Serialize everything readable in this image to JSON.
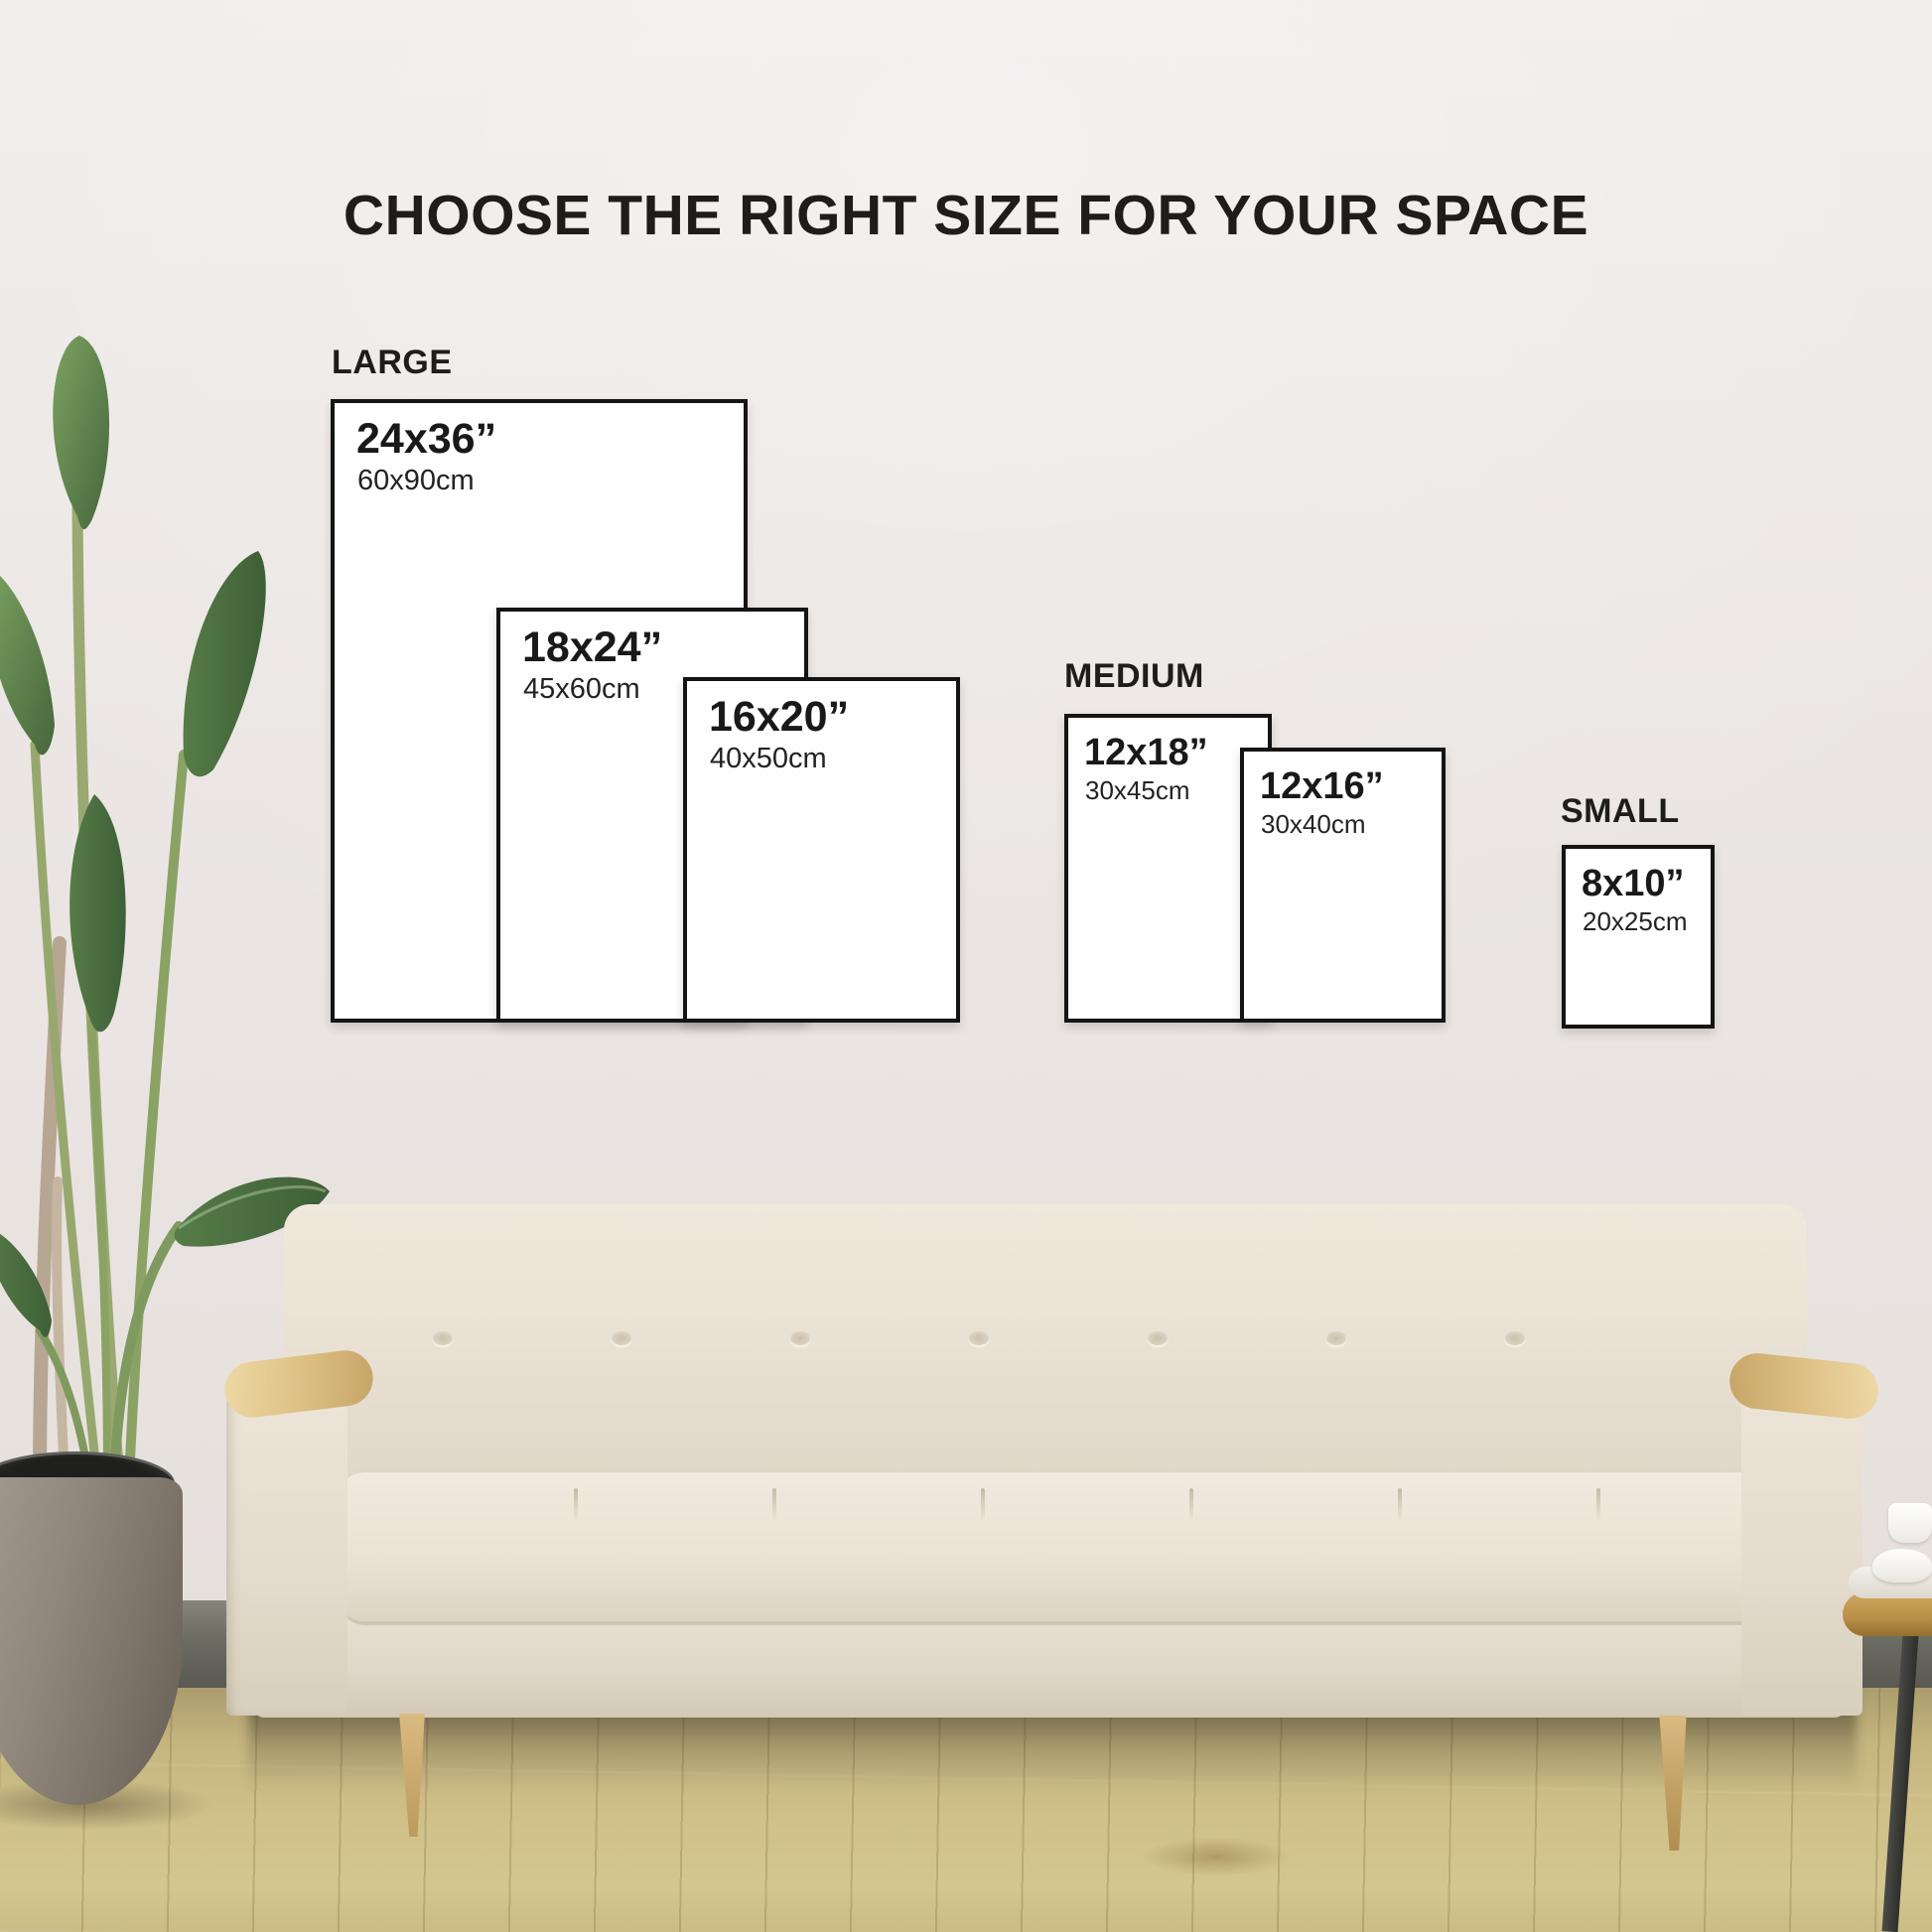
{
  "title": "CHOOSE THE RIGHT SIZE FOR YOUR SPACE",
  "size_groups": [
    {
      "label": "LARGE",
      "sizes": [
        {
          "inches": "24x36”",
          "cm": "60x90cm"
        },
        {
          "inches": "18x24”",
          "cm": "45x60cm"
        },
        {
          "inches": "16x20”",
          "cm": "40x50cm"
        }
      ]
    },
    {
      "label": "MEDIUM",
      "sizes": [
        {
          "inches": "12x18”",
          "cm": "30x45cm"
        },
        {
          "inches": "12x16”",
          "cm": "30x40cm"
        }
      ]
    },
    {
      "label": "SMALL",
      "sizes": [
        {
          "inches": "8x10”",
          "cm": "20x25cm"
        }
      ]
    }
  ],
  "colors": {
    "wall": "#ebe6e4",
    "floor_wood": "#cdbd87",
    "baseboard": "#6b6a60",
    "frame_fill": "#fefefe",
    "frame_border": "#141414",
    "text": "#1e1d1c",
    "couch_fabric": "#e8e1d3",
    "couch_wood": "#d9ba80",
    "plant_leaf": "#5d8049",
    "plant_pot": "#857c71"
  }
}
